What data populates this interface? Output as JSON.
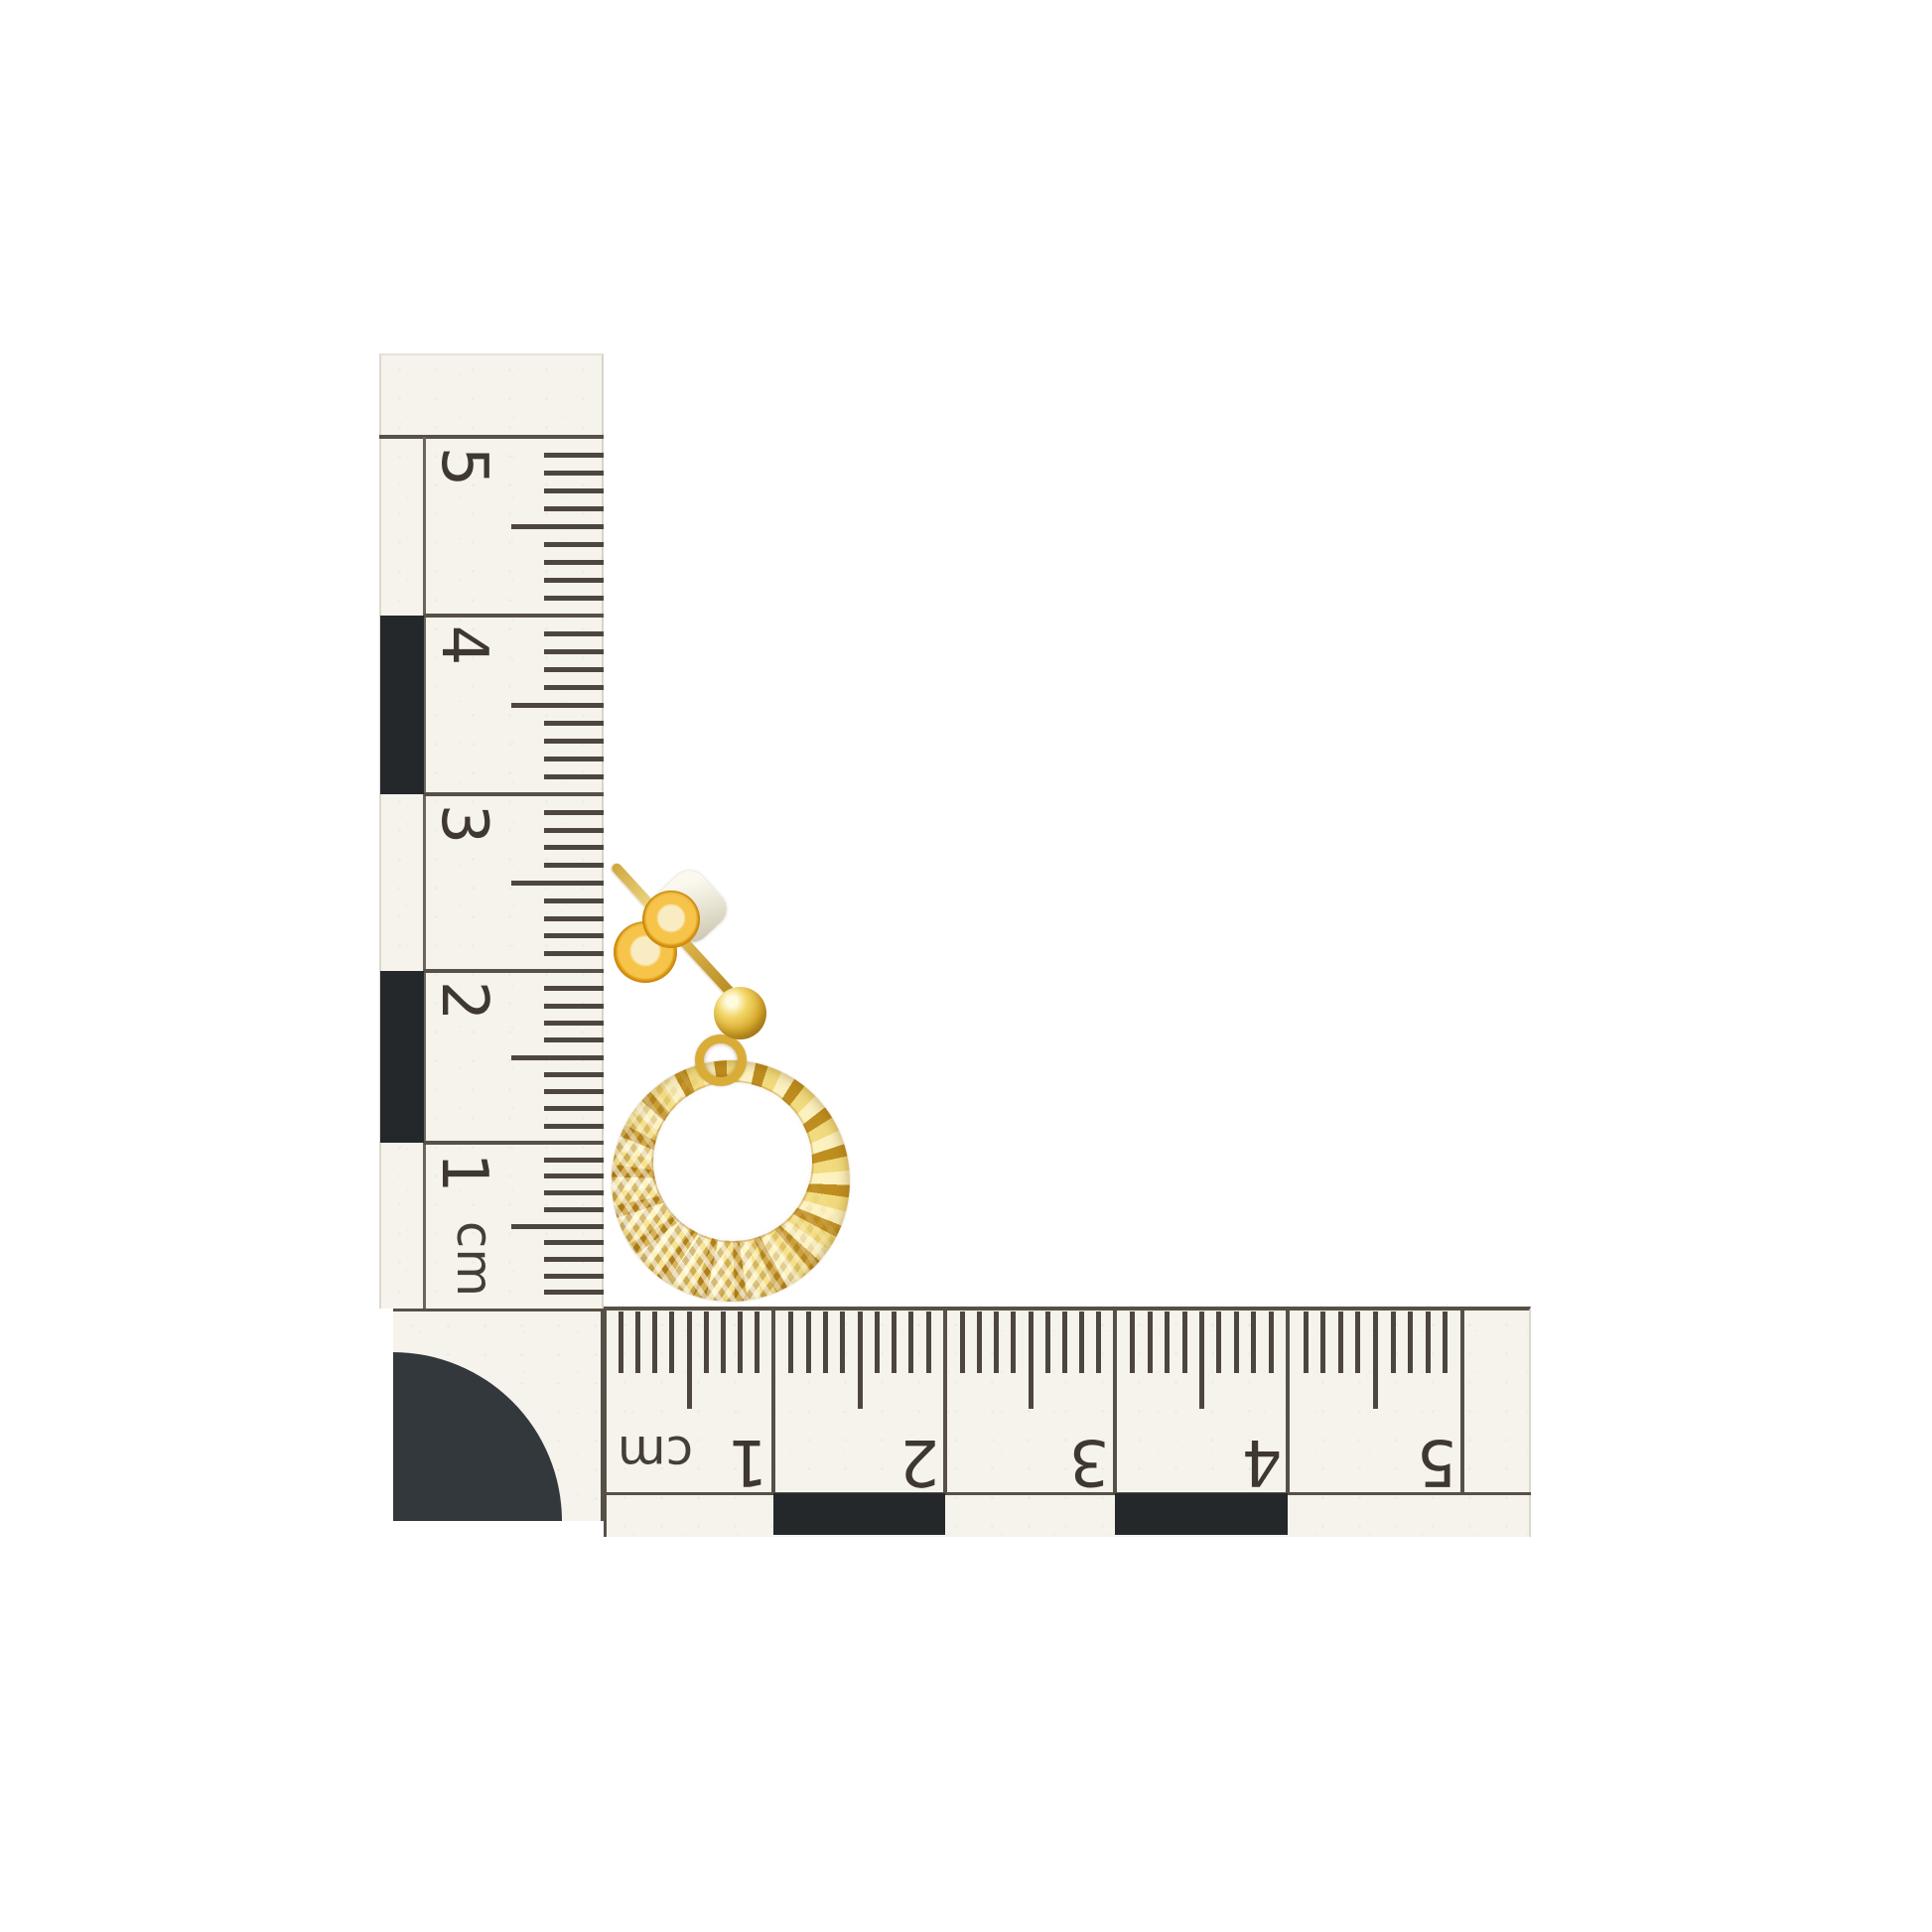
{
  "scene": {
    "background_color": "#ffffff",
    "subject": "Yellow gold diamond-cut open-circle drop earring with ball stud post and butterfly back",
    "setting": "L-shaped centimetre photographic scale with black calibration blocks and quarter-circle corner marker"
  },
  "vertical_ruler": {
    "unit_label": "cm",
    "tick_numbers": [
      "5",
      "4",
      "3",
      "2",
      "1"
    ],
    "minor_ticks_per_cm": 10,
    "paper_color": "#f6f3ec",
    "ink_color": "#4d463e",
    "line_color": "#575047",
    "block_color": "#24282b"
  },
  "horizontal_ruler": {
    "unit_label": "cm",
    "tick_numbers": [
      "1",
      "2",
      "3",
      "4",
      "5"
    ],
    "minor_ticks_per_cm": 10,
    "paper_color": "#f6f3ec",
    "ink_color": "#4d463e",
    "line_color": "#575047",
    "block_color": "#24282b"
  },
  "corner_marker": {
    "shape": "quarter-circle",
    "color": "#33383c",
    "radius_cm": 1
  },
  "earring": {
    "gold_base": "#d4ab3a",
    "gold_highlight": "#f8ecba",
    "gold_shadow": "#9c7314",
    "butterfly_gold": "#f0a81f",
    "pad_color": "#efead9",
    "parts": [
      "ear post",
      "butterfly back",
      "silicone pad",
      "gold bead",
      "jump ring",
      "diamond-cut open circle pendant"
    ]
  }
}
